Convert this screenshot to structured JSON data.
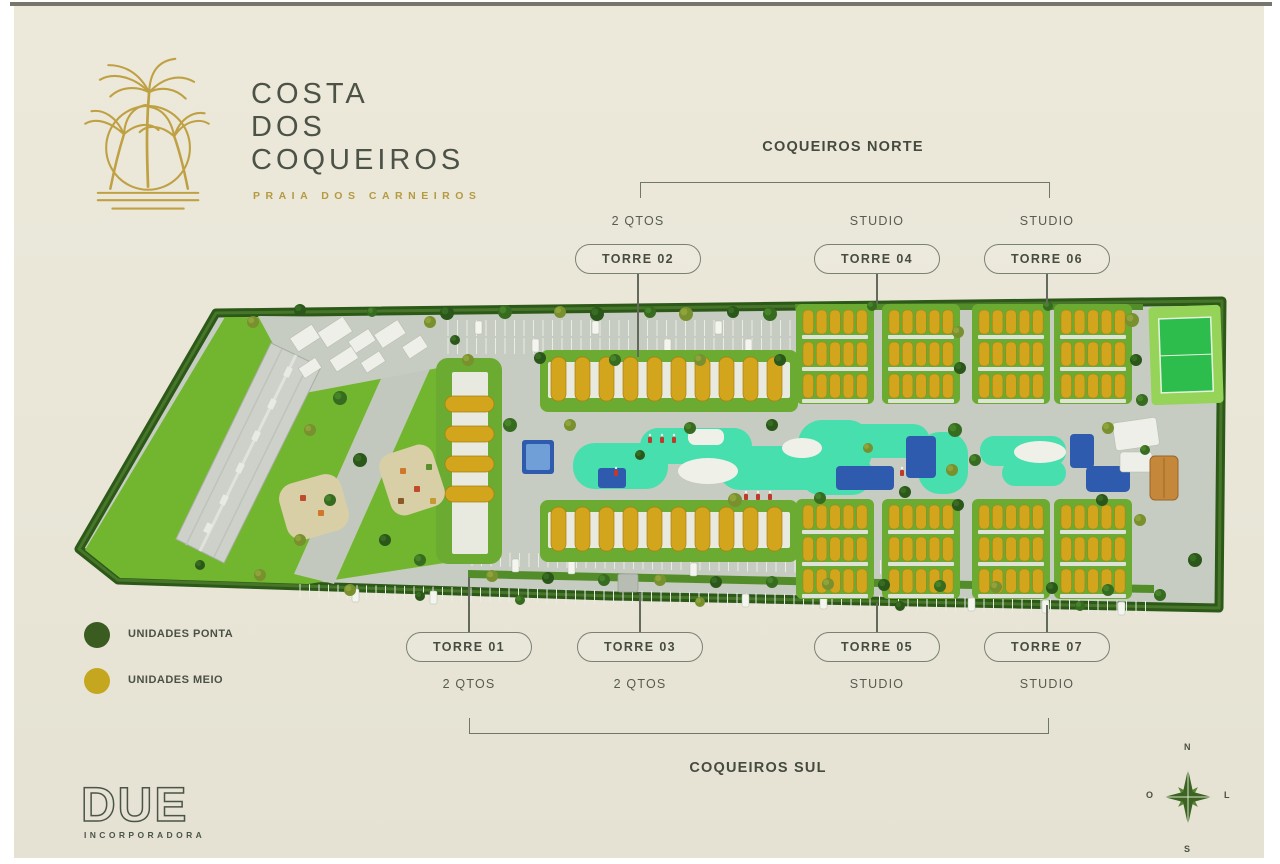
{
  "brand": {
    "title": "COSTA\nDOS\nCOQUEIROS",
    "subtitle": "PRAIA DOS CARNEIROS"
  },
  "sections": {
    "north": "COQUEIROS NORTE",
    "south": "COQUEIROS SUL"
  },
  "towers": [
    {
      "label": "TORRE 02",
      "type": "2 QTOS",
      "group": "COQUEIROS NORTE"
    },
    {
      "label": "TORRE 04",
      "type": "STUDIO",
      "group": "COQUEIROS NORTE"
    },
    {
      "label": "TORRE 06",
      "type": "STUDIO",
      "group": "COQUEIROS NORTE"
    },
    {
      "label": "TORRE 01",
      "type": "2 QTOS",
      "group": "COQUEIROS SUL"
    },
    {
      "label": "TORRE 03",
      "type": "2 QTOS",
      "group": "COQUEIROS SUL"
    },
    {
      "label": "TORRE 05",
      "type": "STUDIO",
      "group": "COQUEIROS SUL"
    },
    {
      "label": "TORRE 07",
      "type": "STUDIO",
      "group": "COQUEIROS SUL"
    }
  ],
  "legend": [
    {
      "label": "UNIDADES PONTA",
      "color": "#3a5c20"
    },
    {
      "label": "UNIDADES MEIO",
      "color": "#c4a71f"
    }
  ],
  "developer": {
    "name": "DUE",
    "descriptor": "INCORPORADORA"
  },
  "compass": {
    "n": "N",
    "s": "S",
    "w": "O",
    "e": "L"
  },
  "colors": {
    "accent_gold": "#bfa144",
    "text_dark": "#4a4f43",
    "hedge_green": "#2c5918",
    "lawn_green": "#72b62f",
    "roof_yellow": "#d3a51c",
    "pool_mint": "#46dfad",
    "pool_blue": "#2e5bad",
    "road_gray": "#c6ccc1"
  }
}
